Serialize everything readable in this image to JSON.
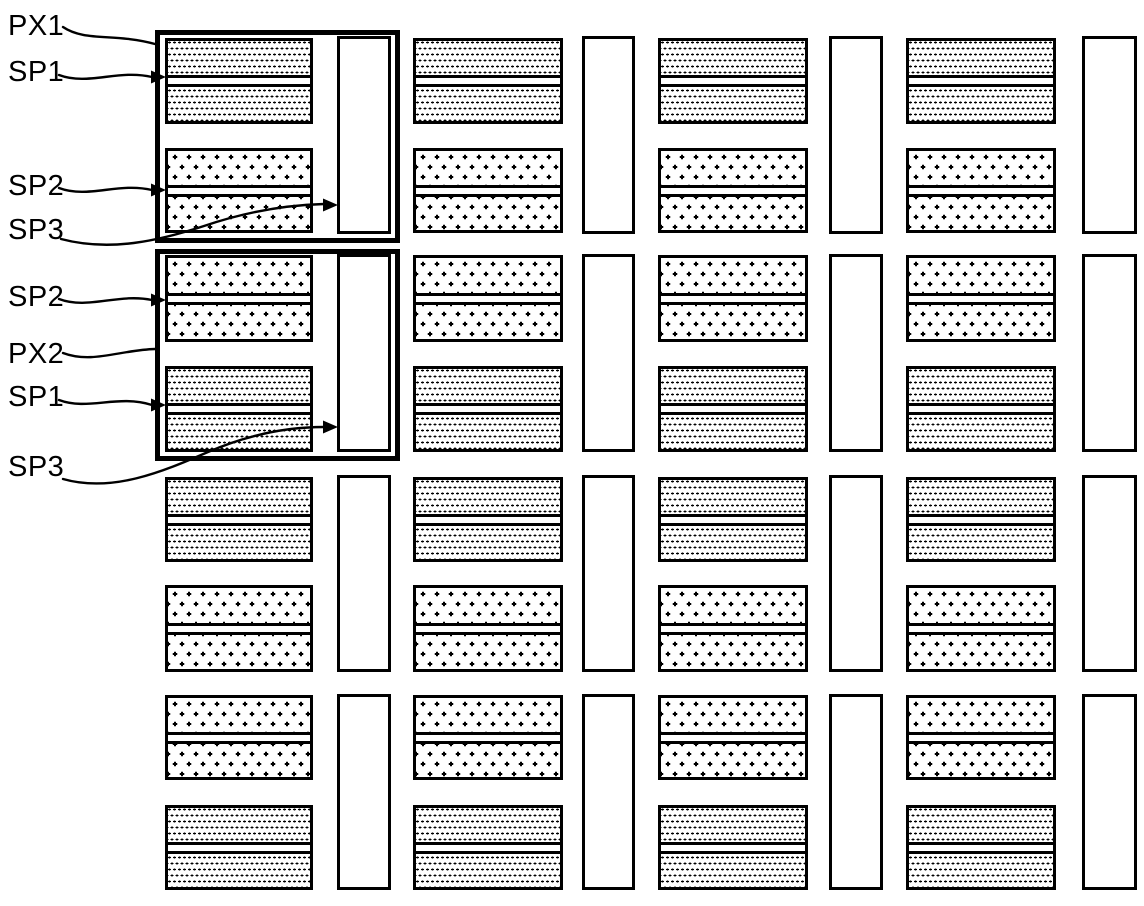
{
  "figure": {
    "colors": {
      "ink": "#000000",
      "paper": "#ffffff"
    },
    "labels": [
      {
        "id": "px1",
        "text": "PX1",
        "x": 8,
        "y": 27
      },
      {
        "id": "sp1-top",
        "text": "SP1",
        "x": 8,
        "y": 73
      },
      {
        "id": "sp2-top",
        "text": "SP2",
        "x": 8,
        "y": 187
      },
      {
        "id": "sp3-top",
        "text": "SP3",
        "x": 8,
        "y": 231
      },
      {
        "id": "sp2-bottom",
        "text": "SP2",
        "x": 8,
        "y": 298
      },
      {
        "id": "px2",
        "text": "PX2",
        "x": 8,
        "y": 355
      },
      {
        "id": "sp1-bottom",
        "text": "SP1",
        "x": 8,
        "y": 398
      },
      {
        "id": "sp3-bottom",
        "text": "SP3",
        "x": 8,
        "y": 468
      }
    ],
    "patterns": {
      "sp1": "fine-dot-stipple",
      "sp2": "plus-cross-stipple",
      "sp3": "blank-white-rect"
    },
    "grid": {
      "block_columns": [
        {
          "x": 165,
          "w": 148
        },
        {
          "x": 413,
          "w": 150
        },
        {
          "x": 658,
          "w": 150
        },
        {
          "x": 906,
          "w": 150
        }
      ],
      "rows": [
        {
          "y": 38,
          "h": 86,
          "pattern": "dots"
        },
        {
          "y": 148,
          "h": 85,
          "pattern": "cross"
        },
        {
          "y": 255,
          "h": 87,
          "pattern": "cross"
        },
        {
          "y": 366,
          "h": 86,
          "pattern": "dots"
        },
        {
          "y": 477,
          "h": 85,
          "pattern": "dots"
        },
        {
          "y": 585,
          "h": 87,
          "pattern": "cross"
        },
        {
          "y": 695,
          "h": 85,
          "pattern": "cross"
        },
        {
          "y": 805,
          "h": 85,
          "pattern": "dots"
        }
      ],
      "spacer_columns": [
        {
          "x": 337,
          "w": 54
        },
        {
          "x": 582,
          "w": 53
        },
        {
          "x": 829,
          "w": 54
        },
        {
          "x": 1082,
          "w": 55
        }
      ],
      "spacer_rows": [
        {
          "y": 36,
          "h": 198
        },
        {
          "y": 254,
          "h": 198
        },
        {
          "y": 475,
          "h": 197
        },
        {
          "y": 694,
          "h": 196
        }
      ]
    },
    "pixel_outlines": [
      {
        "label": "PX1",
        "x": 155,
        "y": 30,
        "w": 245,
        "h": 213
      },
      {
        "label": "PX2",
        "x": 155,
        "y": 249,
        "w": 245,
        "h": 212
      }
    ],
    "leaders": [
      {
        "name": "px1",
        "path": "M 63 27 C 85 42, 115 33, 155 44",
        "arrow": null
      },
      {
        "name": "sp1-top",
        "path": "M 59 75 C 88 86, 118 69, 152 77",
        "arrow": {
          "x": 166,
          "y": 77
        }
      },
      {
        "name": "sp2-top",
        "path": "M 59 188 C 88 199, 118 182, 152 190",
        "arrow": {
          "x": 166,
          "y": 190
        }
      },
      {
        "name": "sp3-top",
        "path": "M 61 239 C 110 252, 158 241, 204 226 C 248 211, 288 205, 324 204",
        "arrow": {
          "x": 338,
          "y": 205
        }
      },
      {
        "name": "sp2-bottom",
        "path": "M 59 299 C 88 310, 118 293, 152 300",
        "arrow": {
          "x": 166,
          "y": 300
        }
      },
      {
        "name": "px2",
        "path": "M 63 353 C 92 364, 120 350, 155 349",
        "arrow": null
      },
      {
        "name": "sp1-bottom",
        "path": "M 59 400 C 88 411, 118 394, 152 405",
        "arrow": {
          "x": 166,
          "y": 405
        }
      },
      {
        "name": "sp3-bottom",
        "path": "M 63 479 C 112 493, 162 472, 208 452 C 252 433, 292 427, 324 427",
        "arrow": {
          "x": 338,
          "y": 427
        }
      }
    ]
  }
}
